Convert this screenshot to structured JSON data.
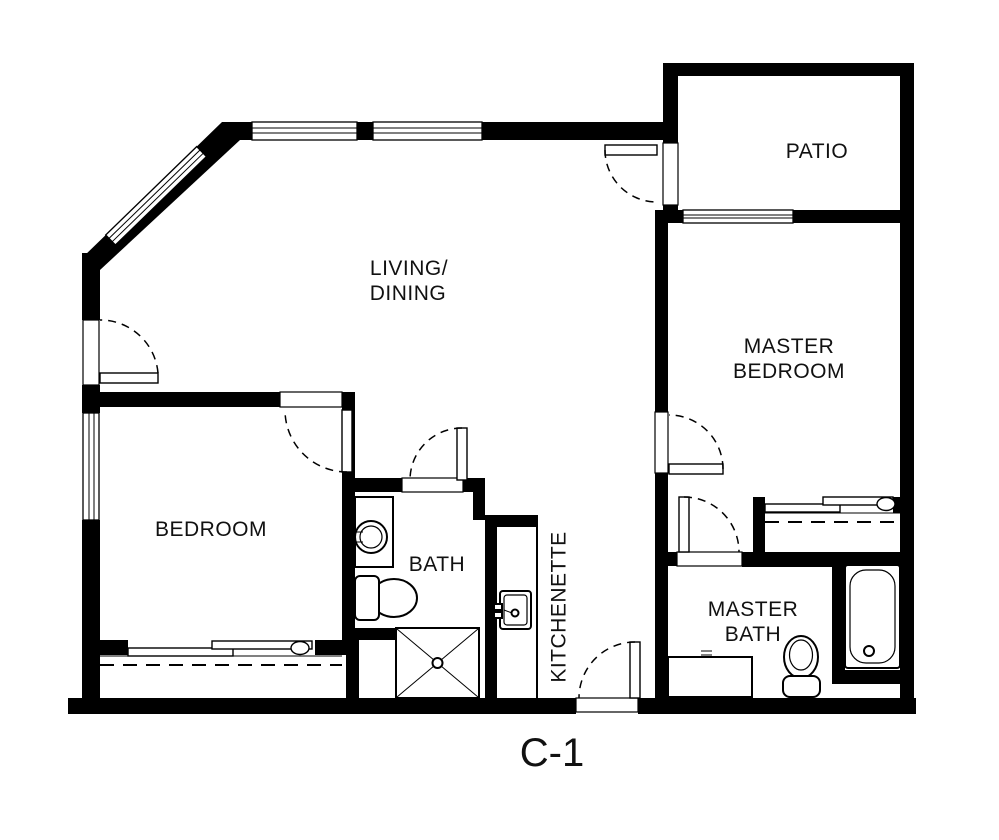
{
  "plan": {
    "unit_label": "C-1",
    "rooms": {
      "living_dining": {
        "line1": "LIVING/",
        "line2": "DINING"
      },
      "patio": {
        "label": "PATIO"
      },
      "master_bedroom": {
        "line1": "MASTER",
        "line2": "BEDROOM"
      },
      "bedroom": {
        "label": "BEDROOM"
      },
      "bath": {
        "label": "BATH"
      },
      "kitchenette": {
        "label": "KITCHENETTE"
      },
      "master_bath": {
        "line1": "MASTER",
        "line2": "BATH"
      }
    },
    "colors": {
      "wall": "#000000",
      "background": "#ffffff",
      "text": "#111111"
    }
  }
}
